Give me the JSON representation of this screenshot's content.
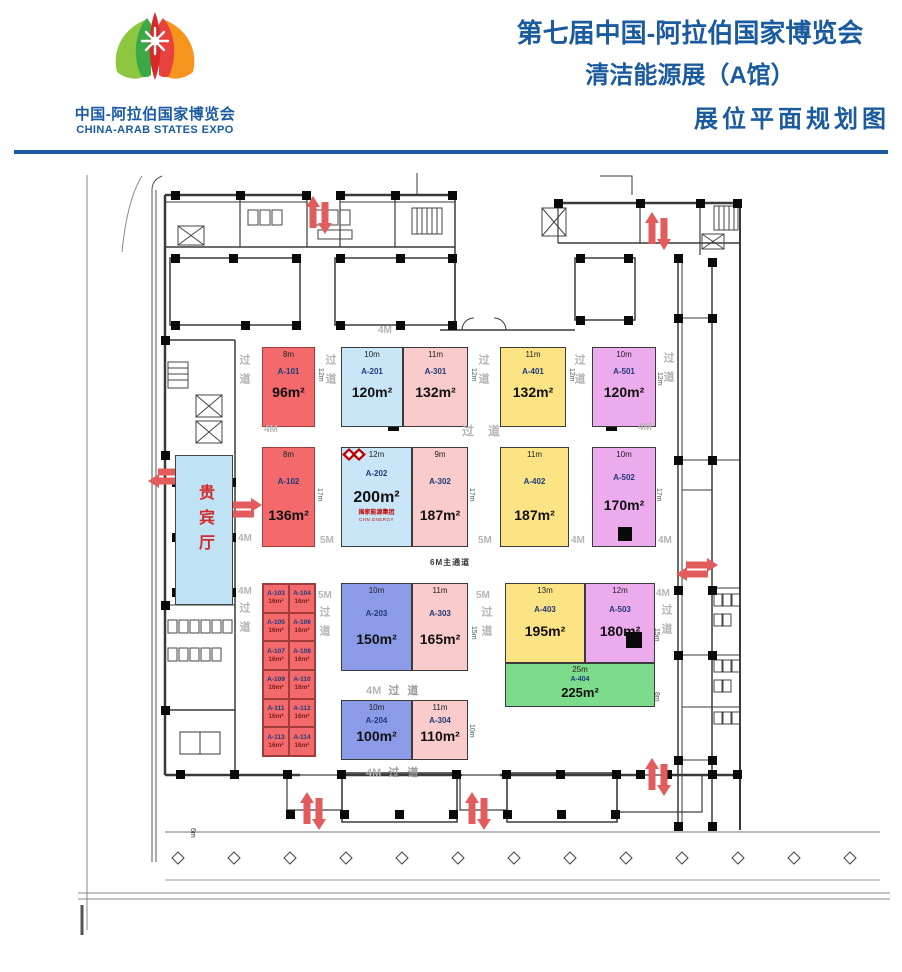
{
  "header": {
    "logo_cn": "中国-阿拉伯国家博览会",
    "logo_en": "CHINA-ARAB STATES EXPO",
    "title_line1": "第七届中国-阿拉伯国家博览会",
    "title_line2": "清洁能源展（A馆）",
    "title_line3": "展位平面规划图",
    "accent_color": "#1A5A9E"
  },
  "plan": {
    "vip_label": "贵宾厅",
    "labels": {
      "aisle": "过道",
      "main_aisle": "6M主通道",
      "m4": "4M",
      "m5": "5M",
      "d6": "6m",
      "d8": "8m",
      "d10": "10m",
      "d12": "12m",
      "d15": "15m",
      "d17": "17m"
    },
    "booths": {
      "a101": {
        "dim": "8m",
        "code": "A-101",
        "area": "96m²"
      },
      "a201": {
        "dim": "10m",
        "code": "A-201",
        "area": "120m²"
      },
      "a301": {
        "dim": "11m",
        "code": "A-301",
        "area": "132m²"
      },
      "a401": {
        "dim": "11m",
        "code": "A-401",
        "area": "132m²"
      },
      "a501": {
        "dim": "10m",
        "code": "A-501",
        "area": "120m²"
      },
      "a102": {
        "dim": "8m",
        "code": "A-102",
        "area": "136m²"
      },
      "a202": {
        "dim": "12m",
        "code": "A-202",
        "area": "200m²"
      },
      "a302": {
        "dim": "9m",
        "code": "A-302",
        "area": "187m²"
      },
      "a402": {
        "dim": "11m",
        "code": "A-402",
        "area": "187m²"
      },
      "a502": {
        "dim": "10m",
        "code": "A-502",
        "area": "170m²"
      },
      "a203": {
        "dim": "10m",
        "code": "A-203",
        "area": "150m²"
      },
      "a303": {
        "dim": "11m",
        "code": "A-303",
        "area": "165m²"
      },
      "a403": {
        "dim": "13m",
        "code": "A-403",
        "area": "195m²"
      },
      "a503": {
        "dim": "12m",
        "code": "A-503",
        "area": "180m²"
      },
      "a404": {
        "dim": "25m",
        "code": "A-404",
        "area": "225m²"
      },
      "a204": {
        "dim": "10m",
        "code": "A-204",
        "area": "100m²"
      },
      "a304": {
        "dim": "11m",
        "code": "A-304",
        "area": "110m²"
      }
    },
    "small_booths": [
      {
        "code": "A-103",
        "area": "16m²"
      },
      {
        "code": "A-104",
        "area": "16m²"
      },
      {
        "code": "A-105",
        "area": "16m²"
      },
      {
        "code": "A-106",
        "area": "16m²"
      },
      {
        "code": "A-107",
        "area": "16m²"
      },
      {
        "code": "A-108",
        "area": "16m²"
      },
      {
        "code": "A-109",
        "area": "16m²"
      },
      {
        "code": "A-110",
        "area": "16m²"
      },
      {
        "code": "A-111",
        "area": "16m²"
      },
      {
        "code": "A-112",
        "area": "16m²"
      },
      {
        "code": "A-113",
        "area": "16m²"
      },
      {
        "code": "A-114",
        "area": "16m²"
      }
    ],
    "exhibitor_logo": {
      "name": "国家能源集团",
      "sub": "CHN ENERGY"
    },
    "palette": {
      "red": "#F3696C",
      "light_blue": "#C9E6F8",
      "pink": "#F9CBCB",
      "yellow": "#FCE384",
      "violet": "#ECABEC",
      "periwinkle": "#8C9BE8",
      "green": "#7CDC8C",
      "vip_blue": "#BFE2F4",
      "arrow_red": "#E25B5D"
    }
  }
}
